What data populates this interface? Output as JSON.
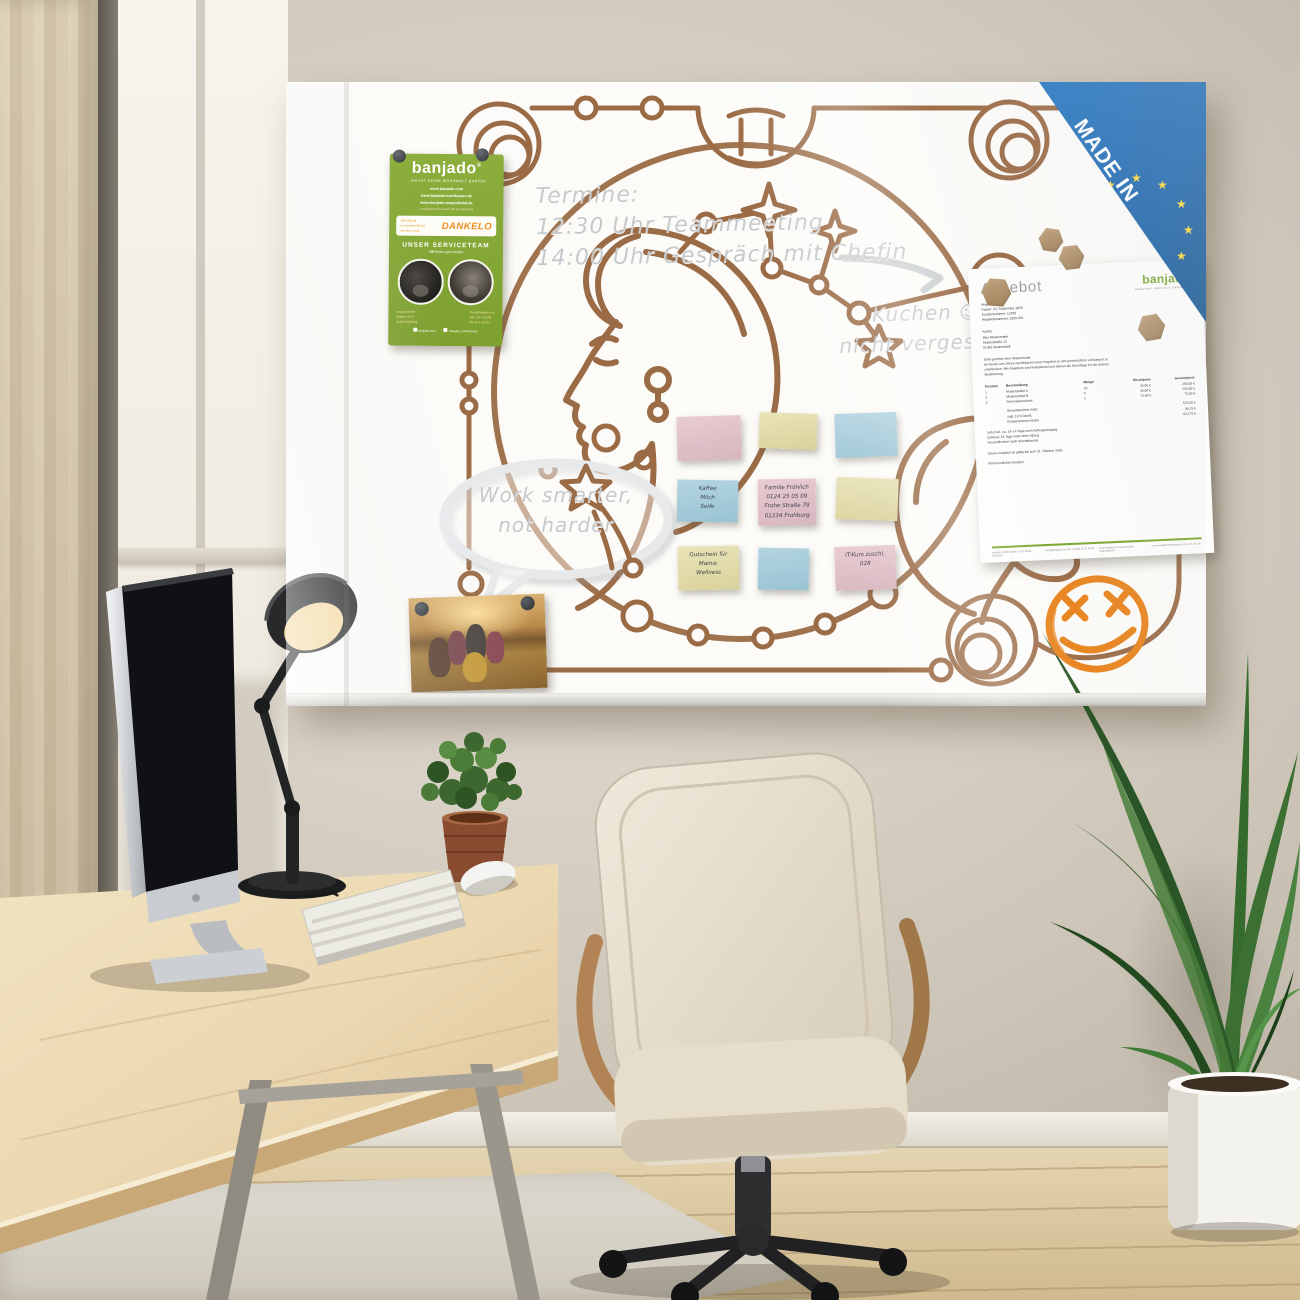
{
  "colors": {
    "line_brown": "#9b6b46",
    "brand_green": "#85a832",
    "badge_blue": "#1e66ad",
    "star_yellow": "#ffd83c",
    "smiley_orange": "#e8831c",
    "note_pink": "#e5c6cd",
    "note_yellow": "#e6e0b2",
    "note_blue": "#aed3e0"
  },
  "board": {
    "handwriting": {
      "termine_title": "Termine:",
      "termine_line1": "12:30 Uhr Teammeeting",
      "termine_line2": "14:00 Uhr Gespräch mit Chefin",
      "kuchen_line1": "Kuchen",
      "kuchen_smiley": "☺",
      "kuchen_line2": "nicht vergessen",
      "bubble_line1": "Work smarter,",
      "bubble_line2": "not harder"
    },
    "badge": {
      "line1": "MADE IN",
      "line2": "EUROPE",
      "star": "★"
    },
    "flyer": {
      "logo": "banjado",
      "logo_mark": "®",
      "tagline": "...MACHT DEINE WOHNWELT BUNTER",
      "url1": "www.banjado.com",
      "url2": "www.banjado-briefkasten.de",
      "url3": "www.banjado-magnettafel.de",
      "url_note": "versandkostenfrei innerhalb Deutschlands",
      "promo_line1": "10% Rabatt",
      "promo_line2": "in unserem Shops",
      "promo_line3": "mit dem Code",
      "promo_code": "DANKELO",
      "service_title": "UNSER SERVICETEAM",
      "service_sub": "hilft Ihnen gern weiter",
      "contact_left": [
        "banjado GmbH",
        "Waldstr. 5b 07",
        "01454 Radeberg"
      ],
      "contact_right": [
        "shop@banjado.com",
        "0351 28 73 00 88",
        "Mo–Fr 8–15 Uhr"
      ],
      "social_left": "banjado.com",
      "social_right": "banjado_onlineshops"
    },
    "notes": [
      {
        "color": "pink",
        "lines": []
      },
      {
        "color": "yellow",
        "lines": []
      },
      {
        "color": "blue",
        "lines": []
      },
      {
        "color": "blue",
        "lines": [
          "Kaffee",
          "Milch",
          "Seife"
        ]
      },
      {
        "color": "pink",
        "lines": [
          "Familie Fröhlich",
          "0124 25 05 09",
          "Frohe Straße 78",
          "01234 Frohburg"
        ]
      },
      {
        "color": "yellow",
        "lines": []
      },
      {
        "color": "yellow",
        "lines": [
          "Gutschein für",
          "Mama:",
          "Wellness"
        ]
      },
      {
        "color": "blue",
        "lines": []
      },
      {
        "color": "pink",
        "lines": [
          "IT-Kurs zuschl.",
          "028"
        ]
      }
    ],
    "document": {
      "title": "Angebot",
      "logo": "banjado",
      "logo_sub": "banjado GmbH · Waldstr. 5b 07 · 01454 Radeberg",
      "meta": [
        "Angebot",
        "Datum: 23. September 2025",
        "Kundennummer: 12345",
        "Angebotsnummer: 2025-001"
      ],
      "customer": [
        "Kunde",
        "Max Mustermann",
        "Musterstraße 12",
        "01462 Musterstadt"
      ],
      "intro1": "Sehr geehrter Herr Mustermann,",
      "intro2": "wir freuen uns, Ihnen nachfolgend unser Angebot zu den gewünschten Leistungen zu",
      "intro3": "unterbreiten. Alle Angebote sind freibleibend und dienen als Grundlage für die weitere",
      "intro4": "Abstimmung.",
      "table": {
        "headers": [
          "Position",
          "Beschreibung",
          "Menge",
          "Einzelpreis",
          "Gesamtpreis"
        ],
        "rows": [
          [
            "1",
            "Musterartikel A",
            "10",
            "25,00 €",
            "250,00 €"
          ],
          [
            "2",
            "Musterartikel B",
            "5",
            "40,00 €",
            "200,00 €"
          ],
          [
            "3",
            "Servicepauschale",
            "1",
            "75,00 €",
            "75,00 €"
          ]
        ],
        "totals": [
          [
            "Gesamtsumme netto",
            "525,00 €"
          ],
          [
            "zzgl. 19 % MwSt.",
            "99,75 €"
          ],
          [
            "Gesamtsumme brutto",
            "624,75 €"
          ]
        ]
      },
      "terms": [
        "Lieferzeit: ca. 10–14 Tage nach Auftragseingang",
        "Zahlung: 14 Tage netto ohne Abzug",
        "Versandkosten nach Vereinbarung"
      ],
      "validity": "Dieses Angebot ist gültig bis zum 31. Oktober 2025.",
      "closing": "Mit freundlichen Grüßen",
      "footer": [
        "banjado GmbH\nWaldstr. 5b 07\n01454 Radeberg",
        "shop@banjado.com\nTel. +49 351 28 73 00 88",
        "www.banjado.com\nwww.banjado-magnettafel.de",
        "www.banjado-briefkasten.de\nMo–Fr 8–15 Uhr"
      ]
    }
  }
}
